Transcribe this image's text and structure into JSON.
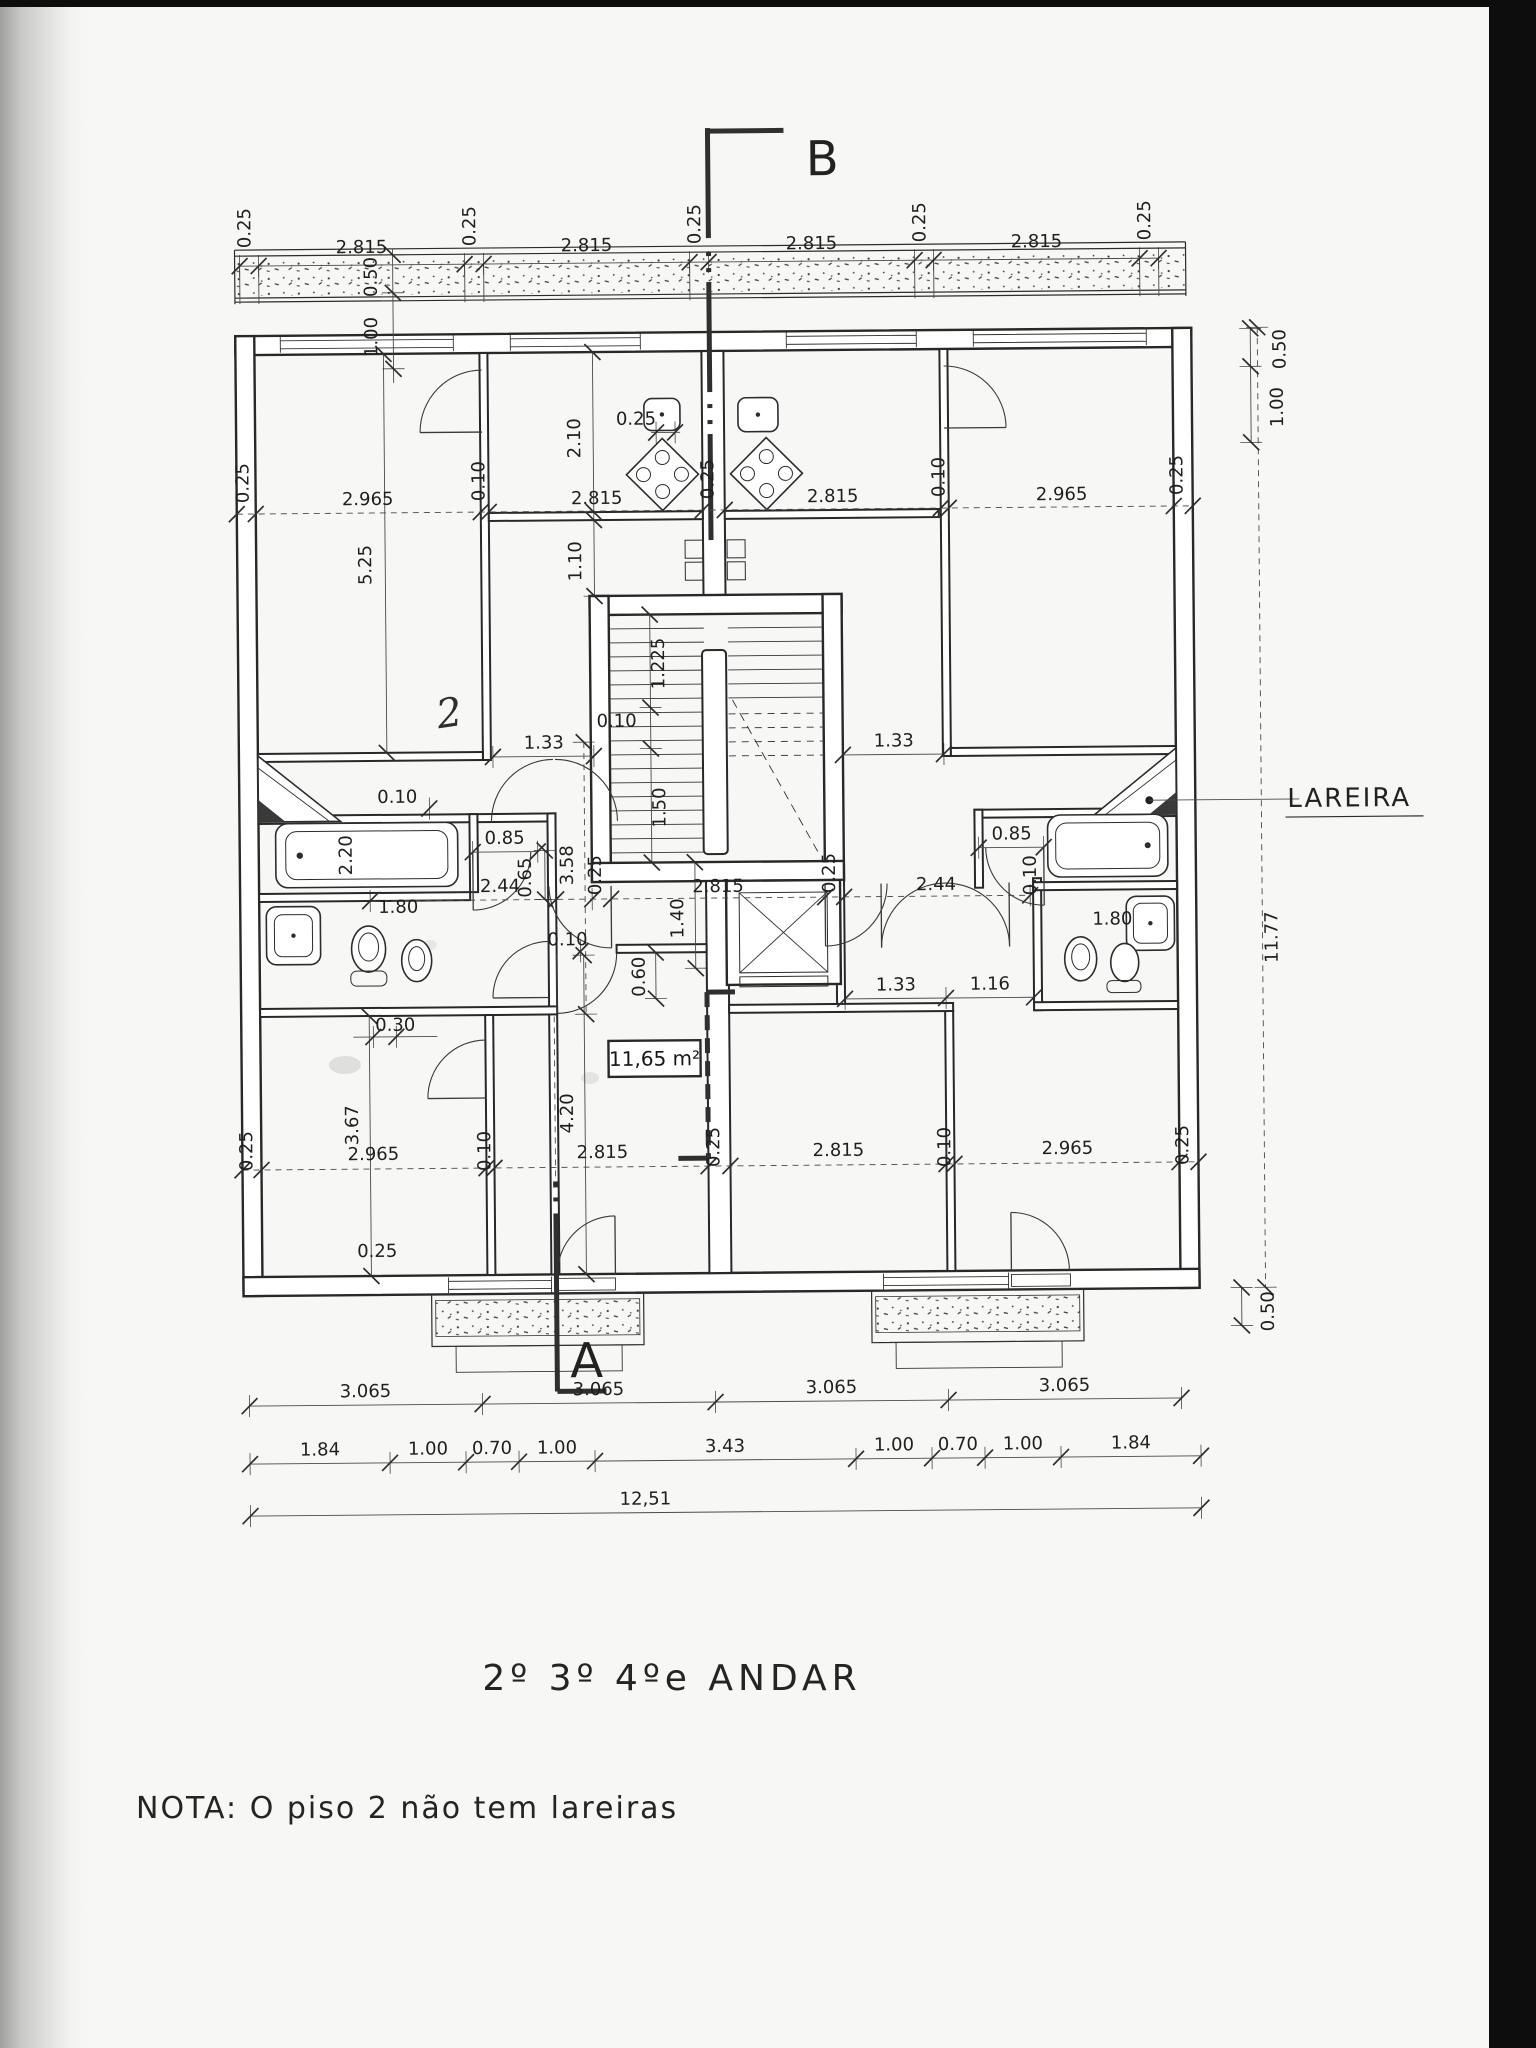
{
  "document": {
    "title": "2º 3º 4ºe ANDAR",
    "note": "NOTA: O  piso 2 não tem lareiras"
  },
  "plan": {
    "section_marker_b": "B",
    "section_marker_a": "A",
    "fireplace_label": "LAREIRA",
    "area_label": "11,65 m²",
    "pencil_mark": "2"
  },
  "dims": {
    "v010": "0.10",
    "v025": "0.25",
    "v030": "0.30",
    "v050": "0.50",
    "v060": "0.60",
    "v065": "0.65",
    "v070": "0.70",
    "v085": "0.85",
    "v100": "1.00",
    "v110": "1.10",
    "v116": "1.16",
    "v1225": "1.225",
    "v133": "1.33",
    "v140": "1.40",
    "v150": "1.50",
    "v180": "1.80",
    "v184": "1.84",
    "v210": "2.10",
    "v220": "2.20",
    "v244": "2.44",
    "v2815": "2.815",
    "v2965": "2.965",
    "v3065": "3.065",
    "v343": "3.43",
    "v358": "3.58",
    "v367": "3.67",
    "v420": "4.20",
    "v525": "5.25",
    "v1177": "11.77",
    "v1251": "12,51"
  }
}
